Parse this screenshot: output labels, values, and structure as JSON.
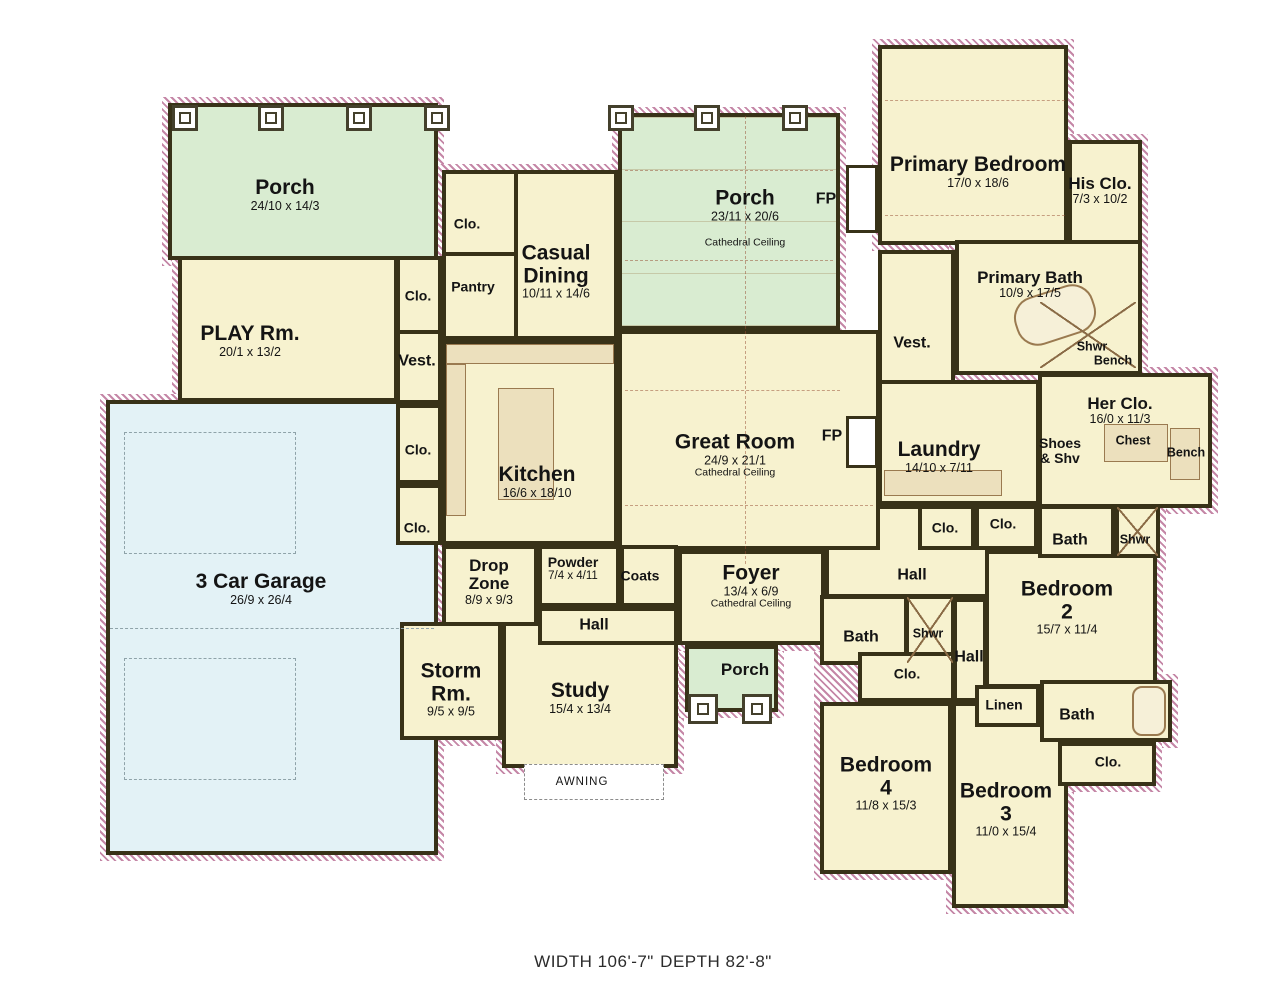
{
  "footer": {
    "width": "WIDTH 106'-7\"",
    "depth": "DEPTH 82'-8\""
  },
  "colors": {
    "room_fill": "#f7f2cf",
    "porch_fill": "#d9ecd1",
    "garage_fill": "#e3f2f6",
    "wall": "#383218",
    "hatch": "#c587a7",
    "fixture": "#ece0bd"
  },
  "rooms": {
    "porch_rear_left": {
      "name": "Porch",
      "dims": "24/10 x 14/3"
    },
    "play_rm": {
      "name": "PLAY Rm.",
      "dims": "20/1 x 13/2"
    },
    "clo_play": {
      "name": "Clo."
    },
    "vest_left": {
      "name": "Vest."
    },
    "clo_dining": {
      "name": "Clo."
    },
    "pantry": {
      "name": "Pantry"
    },
    "casual_dining": {
      "name": "Casual Dining",
      "dims": "10/11 x 14/6"
    },
    "porch_rear_center": {
      "name": "Porch",
      "dims": "23/11 x 20/6",
      "note": "Cathedral Ceiling"
    },
    "fp_porch": {
      "name": "FP"
    },
    "primary_bedroom": {
      "name": "Primary Bedroom",
      "dims": "17/0 x 18/6"
    },
    "his_clo": {
      "name": "His Clo.",
      "dims": "7/3 x 10/2"
    },
    "primary_bath": {
      "name": "Primary Bath",
      "dims": "10/9 x 17/5"
    },
    "shwr_primary": {
      "name": "Shwr"
    },
    "bench_primary": {
      "name": "Bench"
    },
    "vest_right": {
      "name": "Vest."
    },
    "her_clo": {
      "name": "Her Clo.",
      "dims": "16/0 x 11/3"
    },
    "shoes_shv": {
      "name": "Shoes & Shv"
    },
    "chest": {
      "name": "Chest"
    },
    "bench_her": {
      "name": "Bench"
    },
    "great_room": {
      "name": "Great Room",
      "dims": "24/9 x 21/1",
      "note": "Cathedral Ceiling"
    },
    "fp_great": {
      "name": "FP"
    },
    "kitchen": {
      "name": "Kitchen",
      "dims": "16/6 x 18/10"
    },
    "clo_kitchen_1": {
      "name": "Clo."
    },
    "clo_kitchen_2": {
      "name": "Clo."
    },
    "garage": {
      "name": "3 Car Garage",
      "dims": "26/9 x 26/4"
    },
    "drop_zone": {
      "name": "Drop Zone",
      "dims": "8/9 x 9/3"
    },
    "powder": {
      "name": "Powder",
      "dims": "7/4 x 4/11"
    },
    "coats": {
      "name": "Coats"
    },
    "hall_center": {
      "name": "Hall"
    },
    "foyer": {
      "name": "Foyer",
      "dims": "13/4 x 6/9",
      "note": "Cathedral Ceiling"
    },
    "storm_rm": {
      "name": "Storm Rm.",
      "dims": "9/5 x 9/5"
    },
    "study": {
      "name": "Study",
      "dims": "15/4 x 13/4"
    },
    "awning": {
      "name": "AWNING"
    },
    "porch_front": {
      "name": "Porch"
    },
    "laundry": {
      "name": "Laundry",
      "dims": "14/10 x 7/11"
    },
    "clo_hall_1": {
      "name": "Clo."
    },
    "clo_hall_2": {
      "name": "Clo."
    },
    "bath_her_hall": {
      "name": "Bath"
    },
    "shwr_her_hall": {
      "name": "Shwr"
    },
    "hall_bedrooms": {
      "name": "Hall"
    },
    "bedroom_2": {
      "name": "Bedroom",
      "num": "2",
      "dims": "15/7 x 11/4"
    },
    "bath_bed4": {
      "name": "Bath"
    },
    "shwr_bed4": {
      "name": "Shwr"
    },
    "clo_bed4": {
      "name": "Clo."
    },
    "hall_vertical": {
      "name": "Hall"
    },
    "linen": {
      "name": "Linen"
    },
    "bath_beds23": {
      "name": "Bath"
    },
    "clo_bed3": {
      "name": "Clo."
    },
    "bedroom_4": {
      "name": "Bedroom",
      "num": "4",
      "dims": "11/8 x 15/3"
    },
    "bedroom_3": {
      "name": "Bedroom",
      "num": "3",
      "dims": "11/0 x 15/4"
    }
  }
}
